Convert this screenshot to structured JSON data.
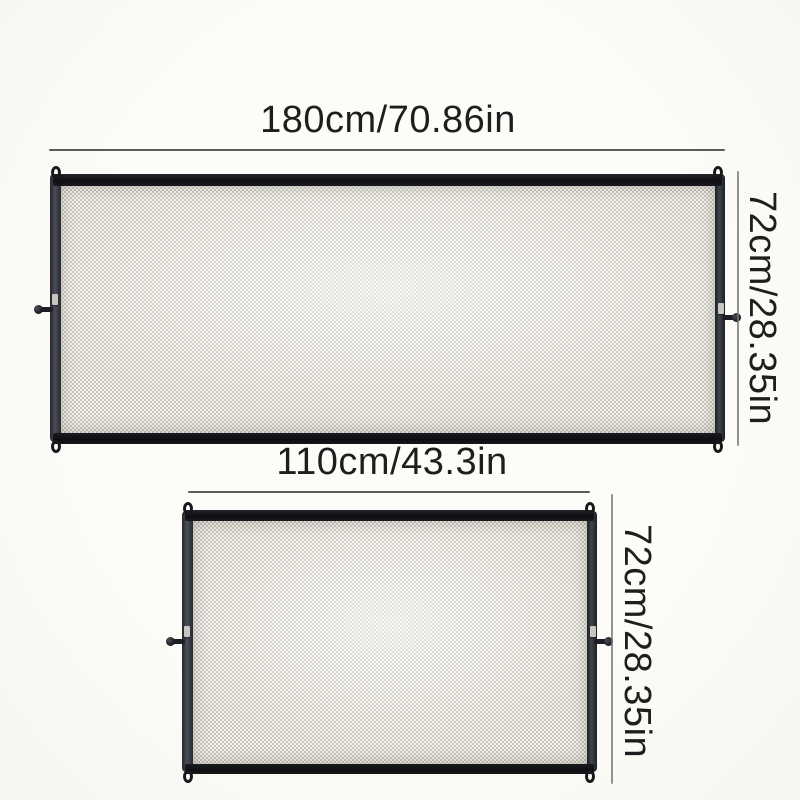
{
  "page": {
    "type": "product-size-diagram",
    "subject": "mesh safety gate",
    "background": "#fbfaf6"
  },
  "colors": {
    "frame_bar": "#111317",
    "frame_side": "#42464f",
    "mesh_base": "#e9e6de",
    "mesh_weave": "#c7c4bc",
    "dimension_line": "#3e3e3e",
    "label_text": "#1e1e1e"
  },
  "product": {
    "variants": [
      {
        "id": "large",
        "width_label": "180cm/70.86in",
        "height_label": "72cm/28.35in",
        "width_cm": 180,
        "width_in": 70.86,
        "height_cm": 72,
        "height_in": 28.35
      },
      {
        "id": "small",
        "width_label": "110cm/43.3in",
        "height_label": "72cm/28.35in",
        "width_cm": 110,
        "width_in": 43.3,
        "height_cm": 72,
        "height_in": 28.35
      }
    ]
  }
}
